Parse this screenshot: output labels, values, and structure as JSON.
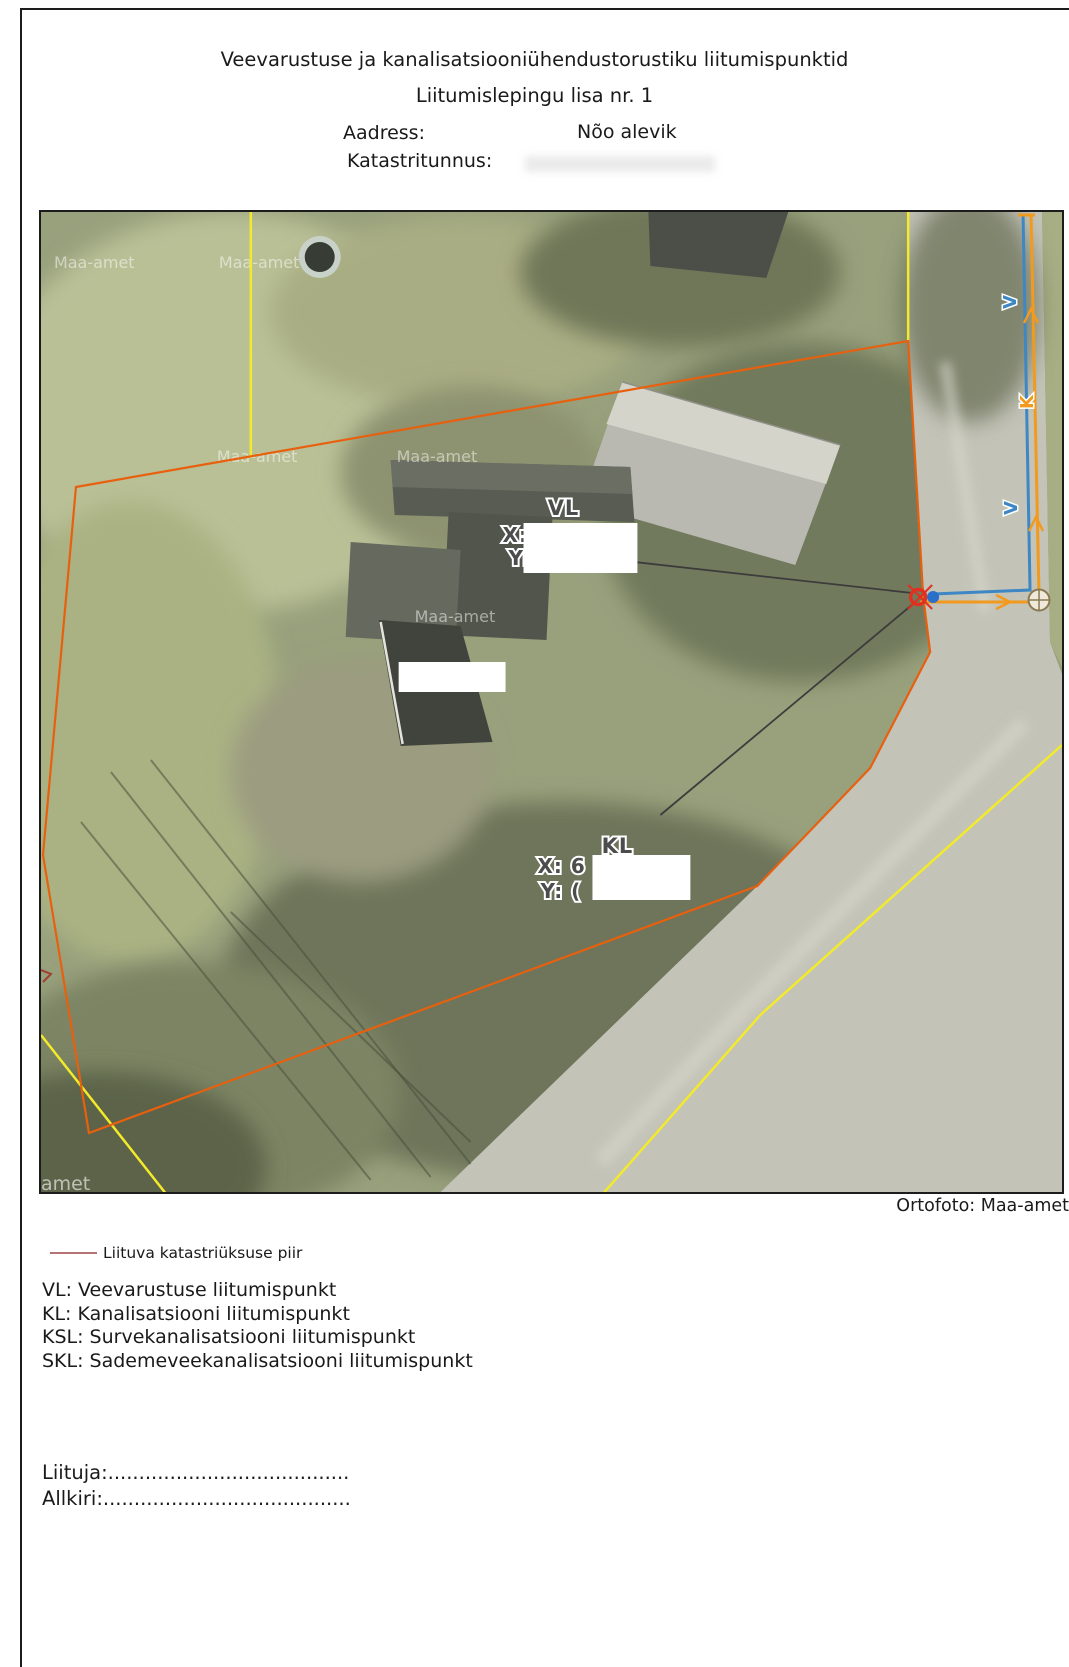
{
  "page": {
    "title_line1": "Veevarustuse ja kanalisatsiooniühendustorustiku liitumispunktid",
    "title_line2": "Liitumislepingu lisa nr. 1",
    "address_label": "Aadress:",
    "address_value": "Nõo alevik",
    "cadastral_label": "Katastritunnus:"
  },
  "map": {
    "credit": "Ortofoto: Maa-amet",
    "watermarks": {
      "w1": "Maa-amet",
      "w2": "Maa-amet",
      "w3": "Maa-amet",
      "w4": "Maa-amet",
      "w5": "Maa-amet",
      "w6": "amet"
    },
    "vl_label": {
      "title": "VL",
      "x": "X:",
      "y": "Y:"
    },
    "kl_label": {
      "title": "KL",
      "x": "X: 6",
      "y": "Y: ("
    },
    "pipes": {
      "water_label": "V",
      "sewer_label": "K"
    }
  },
  "legend": {
    "boundary_label": "Liituva katastriüksuse piir",
    "def_vl": "VL: Veevarustuse liitumispunkt",
    "def_kl": "KL: Kanalisatsiooni liitumispunkt",
    "def_ksl": "KSL: Survekanalisatsiooni liitumispunkt",
    "def_skl": "SKL: Sademeveekanalisatsiooni liitumispunkt"
  },
  "signature": {
    "liituja": "Liituja:.......................................",
    "allkiri": "Allkiri:........................................"
  },
  "colors": {
    "boundary_orange": "#e8600e",
    "road_yellow": "#f2ea2a",
    "water_blue": "#3d87c4",
    "sewer_orange": "#f29a1e",
    "junction_red": "#e03020",
    "junction_blue_dot": "#2a6fc8",
    "manhole_tan": "#8a7a52",
    "legend_line": "#b57373"
  }
}
